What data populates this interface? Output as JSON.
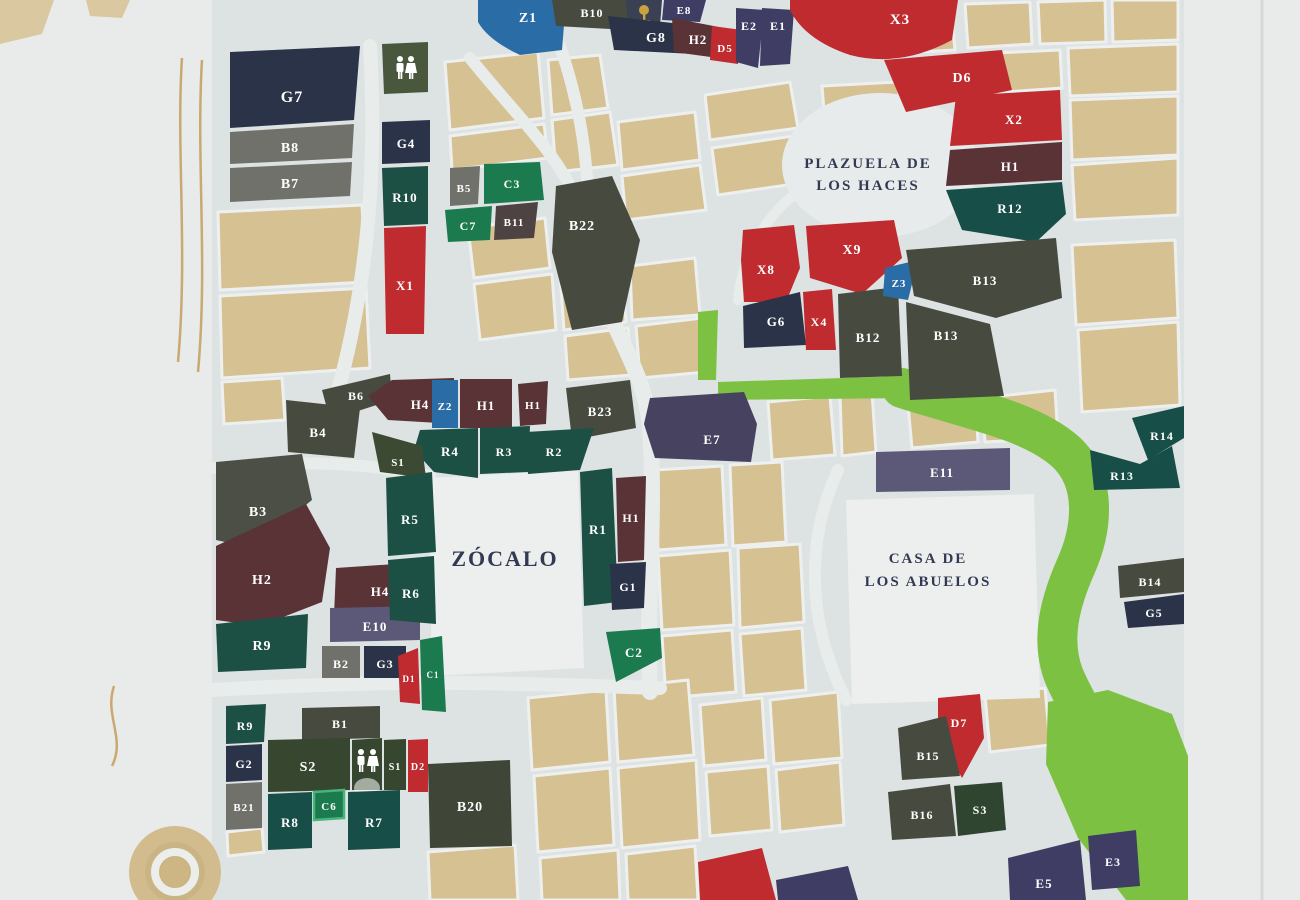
{
  "areas": {
    "plazuela_line1": "PLAZUELA DE",
    "plazuela_line2": "LOS HACES",
    "zocalo": "ZÓCALO",
    "casa_line1": "CASA DE",
    "casa_line2": "LOS ABUELOS"
  },
  "labels": {
    "Z1": "Z1",
    "B10": "B10",
    "E8": "E8",
    "G8": "G8",
    "H2": "H2",
    "D5": "D5",
    "E2": "E2",
    "E1": "E1",
    "X3": "X3",
    "D6": "D6",
    "X2": "X2",
    "H1": "H1",
    "R12": "R12",
    "X8": "X8",
    "X9": "X9",
    "G6": "G6",
    "X4": "X4",
    "B12": "B12",
    "Z3": "Z3",
    "B13": "B13",
    "G7": "G7",
    "B8": "B8",
    "B7": "B7",
    "G4": "G4",
    "R10": "R10",
    "X1": "X1",
    "B5": "B5",
    "C3": "C3",
    "C7": "C7",
    "B11": "B11",
    "B22": "B22",
    "B6": "B6",
    "B4": "B4",
    "H4": "H4",
    "Z2": "Z2",
    "B23": "B23",
    "R4": "R4",
    "R3": "R3",
    "R2": "R2",
    "S1": "S1",
    "E7": "E7",
    "E11": "E11",
    "R14": "R14",
    "R13": "R13",
    "B14": "B14",
    "G5": "G5",
    "B3": "B3",
    "R5": "R5",
    "R6": "R6",
    "R9": "R9",
    "E10": "E10",
    "B2": "B2",
    "G3": "G3",
    "R1": "R1",
    "G1": "G1",
    "C2": "C2",
    "D1": "D1",
    "C1": "C1",
    "B1": "B1",
    "S2": "S2",
    "D2": "D2",
    "C6": "C6",
    "R8": "R8",
    "R7": "R7",
    "B20": "B20",
    "B21": "B21",
    "G2": "G2",
    "D7": "D7",
    "B15": "B15",
    "B16": "B16",
    "S3": "S3",
    "E5": "E5",
    "E3": "E3"
  },
  "icons": {
    "tree": "tree-icon",
    "restroom": "restroom-icon"
  },
  "colors": {
    "parcel_red": "#bf2b2e",
    "parcel_teal": "#1d5044",
    "parcel_green": "#1b7a4e",
    "parcel_navy": "#2b3349",
    "parcel_indigo": "#3f3d63",
    "parcel_purple": "#5b5878",
    "parcel_maroon": "#5a3336",
    "parcel_gray": "#71716b",
    "parcel_darkgray": "#474b3f",
    "parcel_blue": "#2a6ca5",
    "parcel_olive": "#3c4a33",
    "river_green": "#7cc142",
    "block_beige": "#d6c193",
    "road_background": "#dde2e3",
    "poster_margin": "#e9ebea"
  }
}
